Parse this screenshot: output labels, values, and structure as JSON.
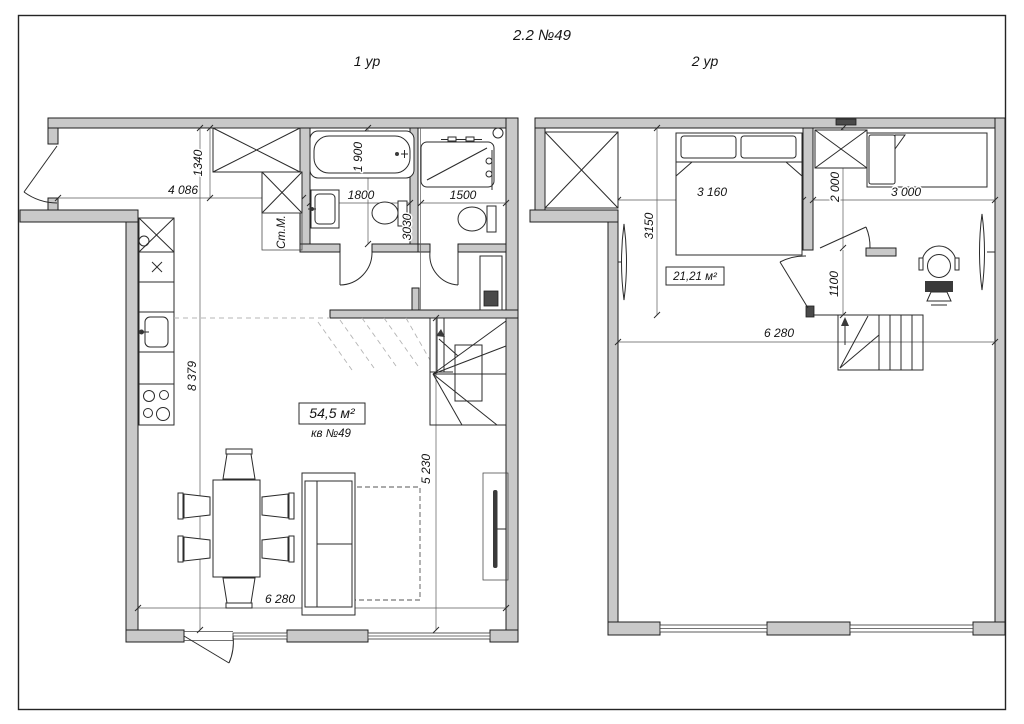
{
  "title": "2.2 №49",
  "plan1": {
    "label": "1 ур",
    "area": "54,5 м²",
    "unit": "кв №49",
    "washer": "Ст.М.",
    "dims": {
      "entry_depth": "1340",
      "hall_width": "4 086",
      "bath1_depth": "1 900",
      "bath1_width": "1800",
      "bath2_depth": "3030",
      "bath2_width": "1500",
      "interior_depth": "8 379",
      "living_depth": "5 230",
      "interior_width": "6 280"
    }
  },
  "plan2": {
    "label": "2 ур",
    "area": "21,21 м²",
    "dims": {
      "bedroom1_depth": "3150",
      "bedroom1_width": "3 160",
      "wardrobe_depth": "2 000",
      "bedroom2_width": "3 000",
      "landing_depth": "1100",
      "interior_width": "6 280"
    }
  },
  "colors": {
    "background": "#ffffff",
    "wall_fill": "#c9c9c9",
    "line": "#1f1f1f"
  }
}
